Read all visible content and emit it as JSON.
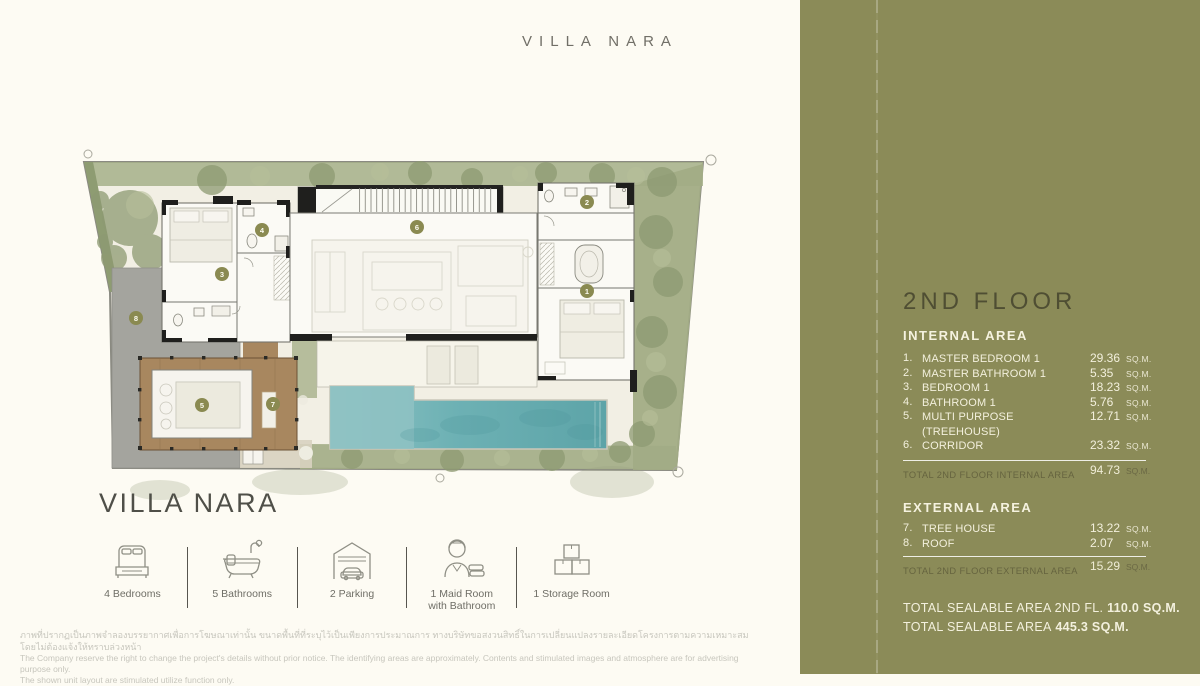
{
  "page": {
    "top_title": "VILLA NARA",
    "villa_name": "VILLA NARA"
  },
  "plan": {
    "room_badges": {
      "b1": "1",
      "b2": "2",
      "b3": "3",
      "b4": "4",
      "b5": "5",
      "b6": "6",
      "b7": "7",
      "b8": "8"
    }
  },
  "features": [
    {
      "icon": "bed-icon",
      "label": "4 Bedrooms",
      "label2": ""
    },
    {
      "icon": "bathtub-icon",
      "label": "5 Bathrooms",
      "label2": ""
    },
    {
      "icon": "garage-icon",
      "label": "2 Parking",
      "label2": ""
    },
    {
      "icon": "maid-icon",
      "label": "1 Maid Room",
      "label2": "with Bathroom"
    },
    {
      "icon": "storage-boxes-icon",
      "label": "1 Storage Room",
      "label2": ""
    }
  ],
  "disclaimer": {
    "line_th": "ภาพที่ปรากฏเป็นภาพจำลองบรรยากาศเพื่อการโฆษณาเท่านั้น ขนาดพื้นที่ที่ระบุไว้เป็นเพียงการประมาณการ ทางบริษัทขอสงวนสิทธิ์ในการเปลี่ยนแปลงรายละเอียดโครงการตามความเหมาะสมโดยไม่ต้องแจ้งให้ทราบล่วงหน้า",
    "line_en1": "The Company reserve the right to change the project's details without prior notice. The identifying areas are approximately. Contents and stimulated images and atmosphere are for advertising purpose only.",
    "line_en2": "The shown unit layout are stimulated utilize function only."
  },
  "panel": {
    "floor_title": "2ND FLOOR",
    "internal": {
      "heading": "INTERNAL AREA",
      "rows": [
        {
          "num": "1.",
          "name": "MASTER BEDROOM 1",
          "name2": "",
          "value": "29.36",
          "unit": "SQ.M."
        },
        {
          "num": "2.",
          "name": "MASTER BATHROOM 1",
          "name2": "",
          "value": "5.35",
          "unit": "SQ.M."
        },
        {
          "num": "3.",
          "name": "BEDROOM 1",
          "name2": "",
          "value": "18.23",
          "unit": "SQ.M."
        },
        {
          "num": "4.",
          "name": "BATHROOM 1",
          "name2": "",
          "value": "5.76",
          "unit": "SQ.M."
        },
        {
          "num": "5.",
          "name": "MULTI PURPOSE",
          "name2": "(TREEHOUSE)",
          "value": "12.71",
          "unit": "SQ.M."
        },
        {
          "num": "6.",
          "name": "CORRIDOR",
          "name2": "",
          "value": "23.32",
          "unit": "SQ.M."
        }
      ],
      "total_label": "TOTAL 2ND FLOOR INTERNAL AREA",
      "total_value": "94.73",
      "total_unit": "SQ.M."
    },
    "external": {
      "heading": "EXTERNAL AREA",
      "rows": [
        {
          "num": "7.",
          "name": "TREE HOUSE",
          "value": "13.22",
          "unit": "SQ.M."
        },
        {
          "num": "8.",
          "name": "ROOF",
          "value": "2.07",
          "unit": "SQ.M."
        }
      ],
      "total_label": "TOTAL 2ND FLOOR EXTERNAL AREA",
      "total_value": "15.29",
      "total_unit": "SQ.M."
    },
    "summary": [
      {
        "label": "TOTAL SEALABLE AREA 2ND FL.",
        "value": "110.0 SQ.M."
      },
      {
        "label": "TOTAL SEALABLE AREA",
        "value": "445.3 SQ.M."
      }
    ],
    "colors": {
      "panel_bg": "#8b8b58",
      "heading_dark": "#4f4e33",
      "text_cream": "#f3f0dd",
      "pool_teal": "#66abae",
      "wood": "#a8875f",
      "badge_olive": "#8a8a51"
    }
  }
}
